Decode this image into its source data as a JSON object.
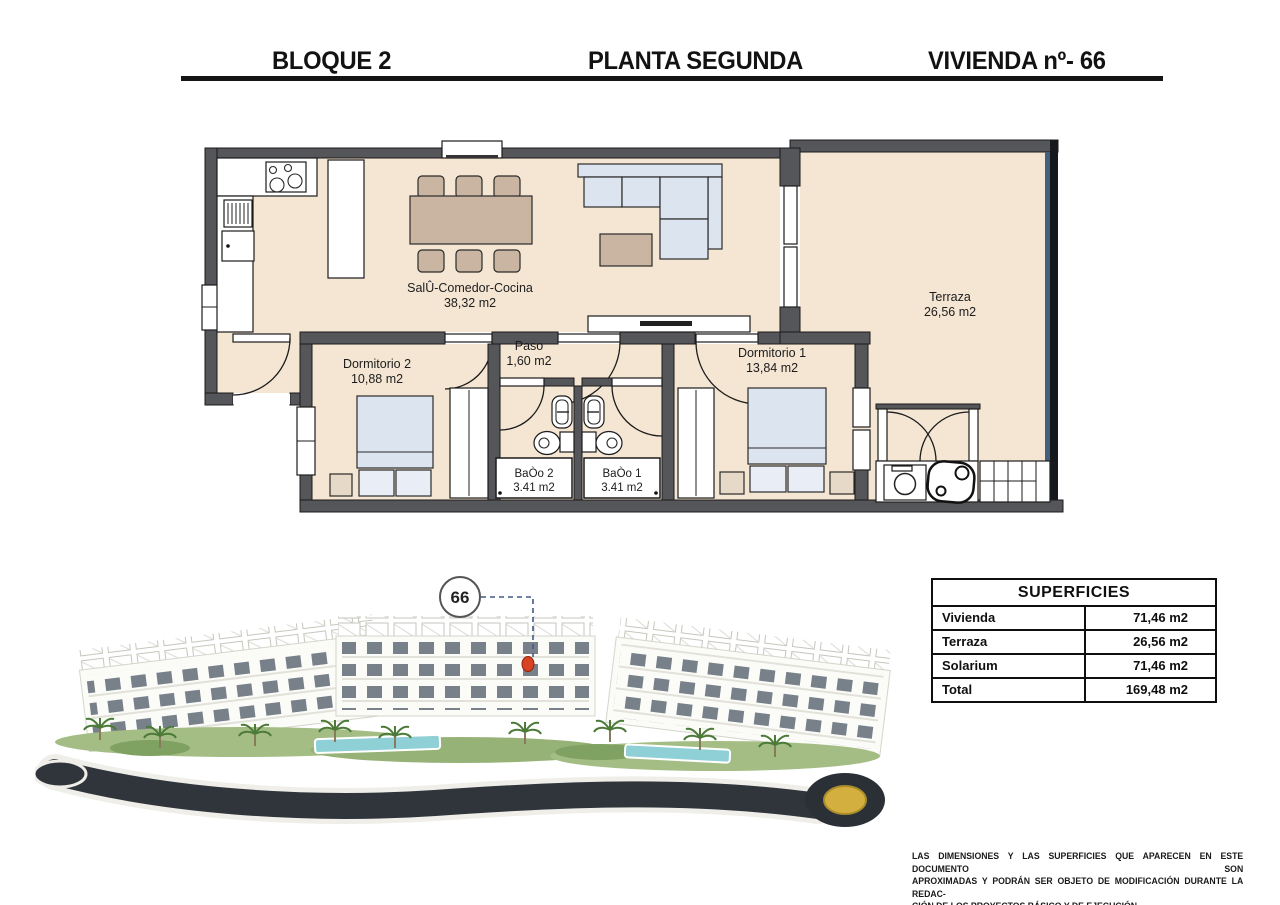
{
  "header": {
    "block": "BLOQUE 2",
    "floor": "PLANTA SEGUNDA",
    "unit": "VIVIENDA nº- 66"
  },
  "plan": {
    "salon": {
      "name": "SalÛ-Comedor-Cocina",
      "area": "38,32 m2"
    },
    "paso": {
      "name": "Paso",
      "area": "1,60 m2"
    },
    "dorm2": {
      "name": "Dormitorio 2",
      "area": "10,88 m2"
    },
    "dorm1": {
      "name": "Dormitorio 1",
      "area": "13,84 m2"
    },
    "bano2": {
      "name": "BaÒo 2",
      "area": "3.41 m2"
    },
    "bano1": {
      "name": "BaÒo 1",
      "area": "3.41 m2"
    },
    "terraza": {
      "name": "Terraza",
      "area": "26,56 m2"
    }
  },
  "site": {
    "unit_marker": "66"
  },
  "table": {
    "title": "SUPERFICIES",
    "rows": [
      {
        "label": "Vivienda",
        "value": "71,46 m2"
      },
      {
        "label": "Terraza",
        "value": "26,56 m2"
      },
      {
        "label": "Solarium",
        "value": "71,46 m2"
      },
      {
        "label": "Total",
        "value": "169,48 m2"
      }
    ]
  },
  "disclaimer": {
    "line1": "LAS DIMENSIONES Y LAS SUPERFICIES QUE APARECEN EN ESTE DOCUMENTO SON",
    "line2": "APROXIMADAS Y PODRÁN SER OBJETO DE MODIFICACIÓN DURANTE LA REDAC-",
    "line3": "CIÓN DE LOS PROYECTOS BÁSICO Y DE EJECUCIÓN"
  },
  "colors": {
    "wall": "#55565a",
    "floor": "#f4e6d3",
    "marker_red": "#d64424",
    "roundabout_gold": "#d2af3e",
    "pool": "#8fd0d6",
    "road": "#30353c",
    "glass_rail": "#42607e"
  }
}
